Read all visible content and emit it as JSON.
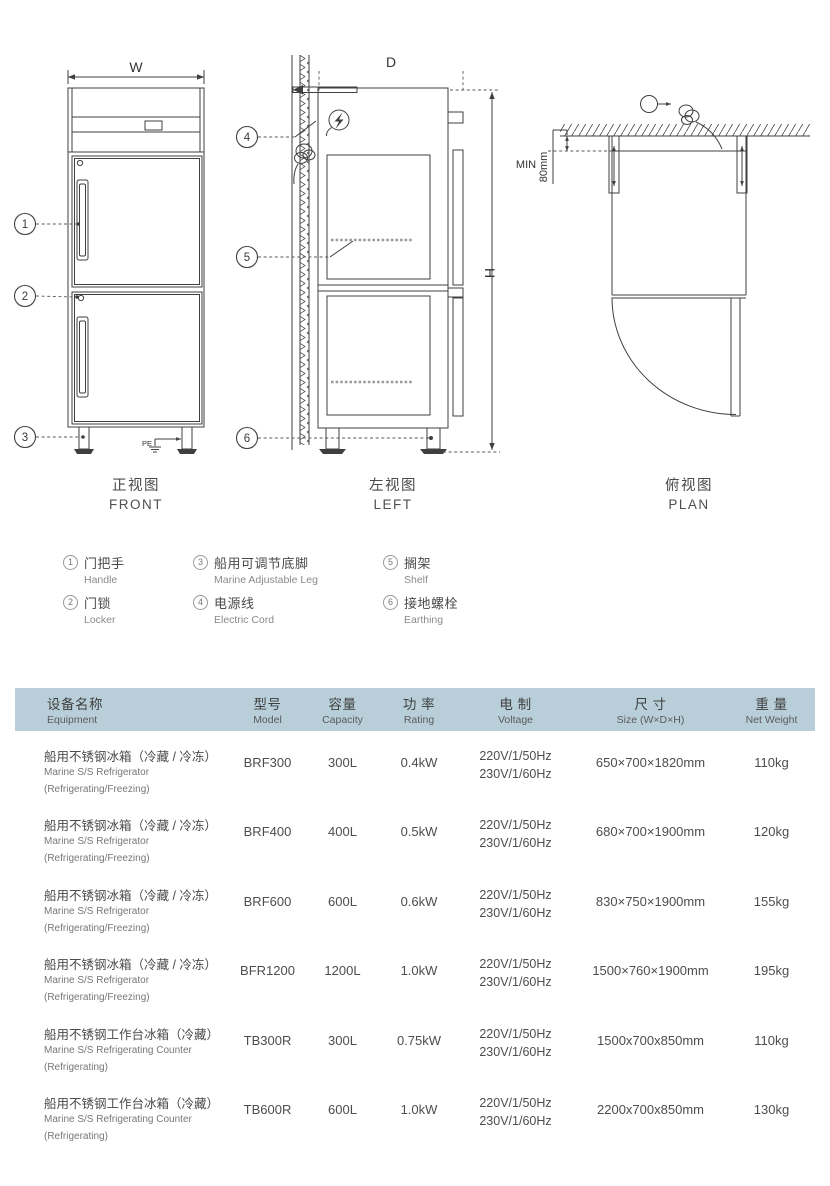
{
  "colors": {
    "header_bg": "#b8cfda",
    "line": "#3f3f3f",
    "text": "#4a4a4a"
  },
  "drawing": {
    "front": {
      "dim_width": "W",
      "pe": "PE",
      "title_zh": "正视图",
      "title_en": "FRONT"
    },
    "left": {
      "dim_depth": "D",
      "dim_height": "H",
      "title_zh": "左视图",
      "title_en": "LEFT"
    },
    "plan": {
      "min_label": "MIN",
      "min_value": "80mm",
      "title_zh": "俯视图",
      "title_en": "PLAN"
    },
    "callouts": [
      "1",
      "2",
      "3",
      "4",
      "5",
      "6"
    ]
  },
  "legend": {
    "items": [
      {
        "num": "1",
        "zh": "门把手",
        "en": "Handle"
      },
      {
        "num": "2",
        "zh": "门锁",
        "en": "Locker"
      },
      {
        "num": "3",
        "zh": "船用可调节底脚",
        "en": "Marine Adjustable Leg"
      },
      {
        "num": "4",
        "zh": "电源线",
        "en": "Electric Cord"
      },
      {
        "num": "5",
        "zh": "搁架",
        "en": "Shelf"
      },
      {
        "num": "6",
        "zh": "接地螺栓",
        "en": "Earthing"
      }
    ]
  },
  "table": {
    "header": {
      "equipment_zh": "设备名称",
      "equipment_en": "Equipment",
      "model_zh": "型号",
      "model_en": "Model",
      "capacity_zh": "容量",
      "capacity_en": "Capacity",
      "rating_zh": "功 率",
      "rating_en": "Rating",
      "voltage_zh": "电 制",
      "voltage_en": "Voltage",
      "size_zh": "尺 寸",
      "size_en": "Size (W×D×H)",
      "weight_zh": "重 量",
      "weight_en": "Net Weight"
    },
    "rows": [
      {
        "name_zh": "船用不锈钢冰箱（冷藏 / 冷冻）",
        "name_en": "Marine S/S Refrigerator",
        "name_sub": "(Refrigerating/Freezing)",
        "model": "BRF300",
        "capacity": "300L",
        "rating": "0.4kW",
        "voltage1": "220V/1/50Hz",
        "voltage2": "230V/1/60Hz",
        "size": "650×700×1820mm",
        "weight": "110kg"
      },
      {
        "name_zh": "船用不锈钢冰箱（冷藏 / 冷冻）",
        "name_en": "Marine S/S Refrigerator",
        "name_sub": "(Refrigerating/Freezing)",
        "model": "BRF400",
        "capacity": "400L",
        "rating": "0.5kW",
        "voltage1": "220V/1/50Hz",
        "voltage2": "230V/1/60Hz",
        "size": "680×700×1900mm",
        "weight": "120kg"
      },
      {
        "name_zh": "船用不锈钢冰箱（冷藏 / 冷冻）",
        "name_en": "Marine S/S Refrigerator",
        "name_sub": "(Refrigerating/Freezing)",
        "model": "BRF600",
        "capacity": "600L",
        "rating": "0.6kW",
        "voltage1": "220V/1/50Hz",
        "voltage2": "230V/1/60Hz",
        "size": "830×750×1900mm",
        "weight": "155kg"
      },
      {
        "name_zh": "船用不锈钢冰箱（冷藏 / 冷冻）",
        "name_en": "Marine S/S Refrigerator",
        "name_sub": "(Refrigerating/Freezing)",
        "model": "BFR1200",
        "capacity": "1200L",
        "rating": "1.0kW",
        "voltage1": "220V/1/50Hz",
        "voltage2": "230V/1/60Hz",
        "size": "1500×760×1900mm",
        "weight": "195kg"
      },
      {
        "name_zh": "船用不锈钢工作台冰箱（冷藏）",
        "name_en": "Marine S/S Refrigerating Counter",
        "name_sub": "(Refrigerating)",
        "model": "TB300R",
        "capacity": "300L",
        "rating": "0.75kW",
        "voltage1": "220V/1/50Hz",
        "voltage2": "230V/1/60Hz",
        "size": "1500x700x850mm",
        "weight": "110kg"
      },
      {
        "name_zh": "船用不锈钢工作台冰箱（冷藏）",
        "name_en": "Marine S/S Refrigerating Counter",
        "name_sub": "(Refrigerating)",
        "model": "TB600R",
        "capacity": "600L",
        "rating": "1.0kW",
        "voltage1": "220V/1/50Hz",
        "voltage2": "230V/1/60Hz",
        "size": "2200x700x850mm",
        "weight": "130kg"
      }
    ]
  }
}
